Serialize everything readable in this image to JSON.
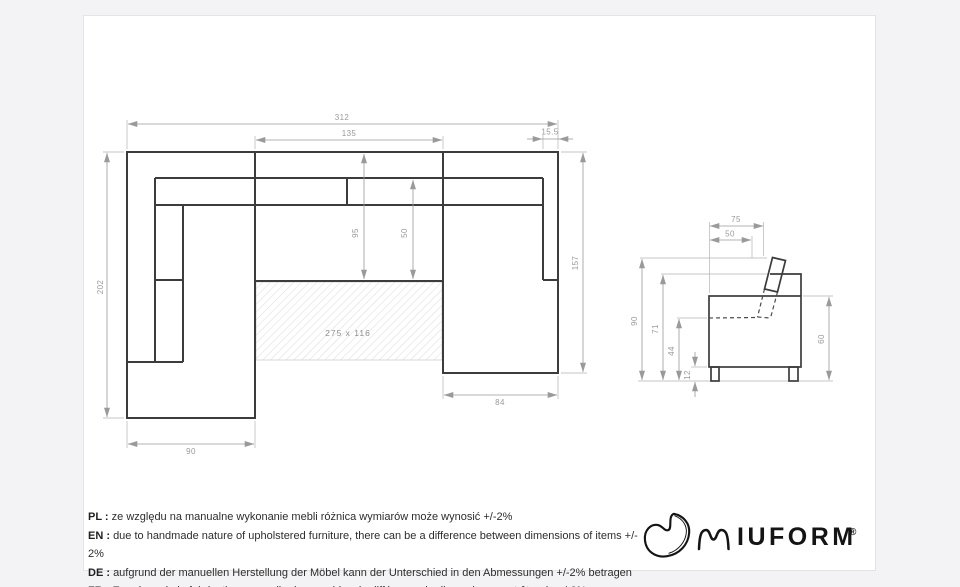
{
  "colors": {
    "background": "#f3f3f5",
    "sheet": "#ffffff",
    "structure_line": "#3c3c3c",
    "dimension_line": "#9a9a9a",
    "hatch_line": "#dedede",
    "disclaimer_text": "#2d2d2d",
    "logo": "#141414"
  },
  "top_view": {
    "width_total": "312",
    "width_middle": "135",
    "armrest_right_width": "15.5",
    "depth_left": "202",
    "depth_right": "157",
    "seat_depth_with_back": "95",
    "seat_depth": "50",
    "chaise_left_width": "90",
    "chaise_right_width": "84",
    "sleeping_area": "275 x 116"
  },
  "side_view": {
    "depth_total": "75",
    "seat_depth": "50",
    "height_total": "90",
    "height_backrest": "71",
    "height_seat": "44",
    "height_legs": "12",
    "height_armrest": "60"
  },
  "disclaimer": {
    "items": [
      {
        "label": "PL :",
        "text": "ze względu na manualne wykonanie mebli różnica wymiarów może wynosić +/-2%"
      },
      {
        "label": "EN :",
        "text": "due to handmade nature of upholstered furniture, there can be a difference between dimensions of items +/- 2%"
      },
      {
        "label": "DE :",
        "text": "aufgrund der manuellen Herstellung der Möbel kann der Unterschied in den Abmessungen +/-2% betragen"
      },
      {
        "label": "FR :",
        "text": "En raison de la fabrication manuelle des meubles, la différence de dimensions peut être de +/-2%"
      }
    ]
  },
  "logo": {
    "wordmark": "IUFORM",
    "registered": "®",
    "icons": {
      "bean": "bean-logo-icon",
      "wave_m": "wave-m-icon"
    }
  }
}
